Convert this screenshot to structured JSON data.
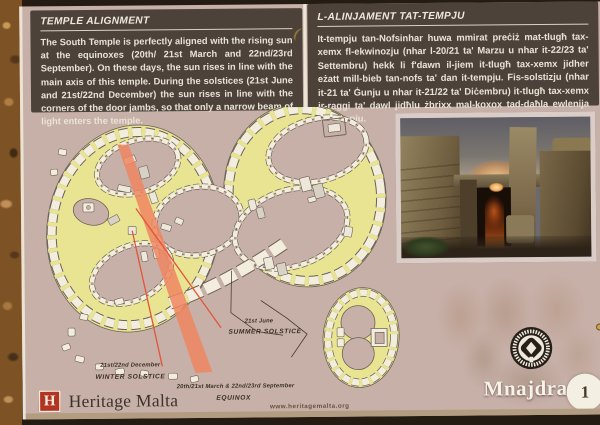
{
  "sign": {
    "panels": {
      "en": {
        "title": "TEMPLE ALIGNMENT",
        "body": "The South Temple is perfectly aligned with the rising sun at the equinoxes (20th/ 21st March and 22nd/23rd September). On these days, the sun rises in line with the main axis of this temple. During the solstices (21st June and 21st/22nd December) the sun rises in line with the corners of the door jambs, so that only a narrow beam of light enters the temple."
      },
      "mt": {
        "title": "L-ALINJAMENT TAT-TEMPJU",
        "body": "It-tempju tan-Nofsinhar huwa mmirat preċiż mat-tlugħ tax-xemx fl-ekwinozju (nhar l-20/21 ta' Marzu u nhar it-22/23 ta' Settembru) hekk li f'dawn il-jiem it-tlugħ tax-xemx jidher eżatt mill-bieb tan-nofs ta' dan it-tempju. Fis-solstizju (nhar it-21 ta' Ġunju u nhar it-21/22 ta' Diċembru) it-tlugħ tax-xemx ir-raggi ta' dawl jidħlu żbrixx mal-koxox tad-daħla ewlenija tat-tempju."
      }
    },
    "diagram": {
      "labels": {
        "summer_date": "21st June",
        "summer_name": "SUMMER SOLSTICE",
        "winter_date": "21st/22nd December",
        "winter_name": "WINTER SOLSTICE",
        "equinox_date": "20th/21st March & 22nd/23rd September",
        "equinox_name": "EQUINOX"
      },
      "colors": {
        "temple_wall_yellow": "#e9e492",
        "stone_white": "#f3edde",
        "beam_orange": "#ef8660",
        "solstice_line_red": "#e2553a",
        "plan_background": "#c7b0a8"
      }
    },
    "footer": {
      "logo_letter": "H",
      "brand": "Heritage Malta",
      "website": "www.heritagemalta.org",
      "site_name": "Mnajdra",
      "number": "1"
    }
  }
}
